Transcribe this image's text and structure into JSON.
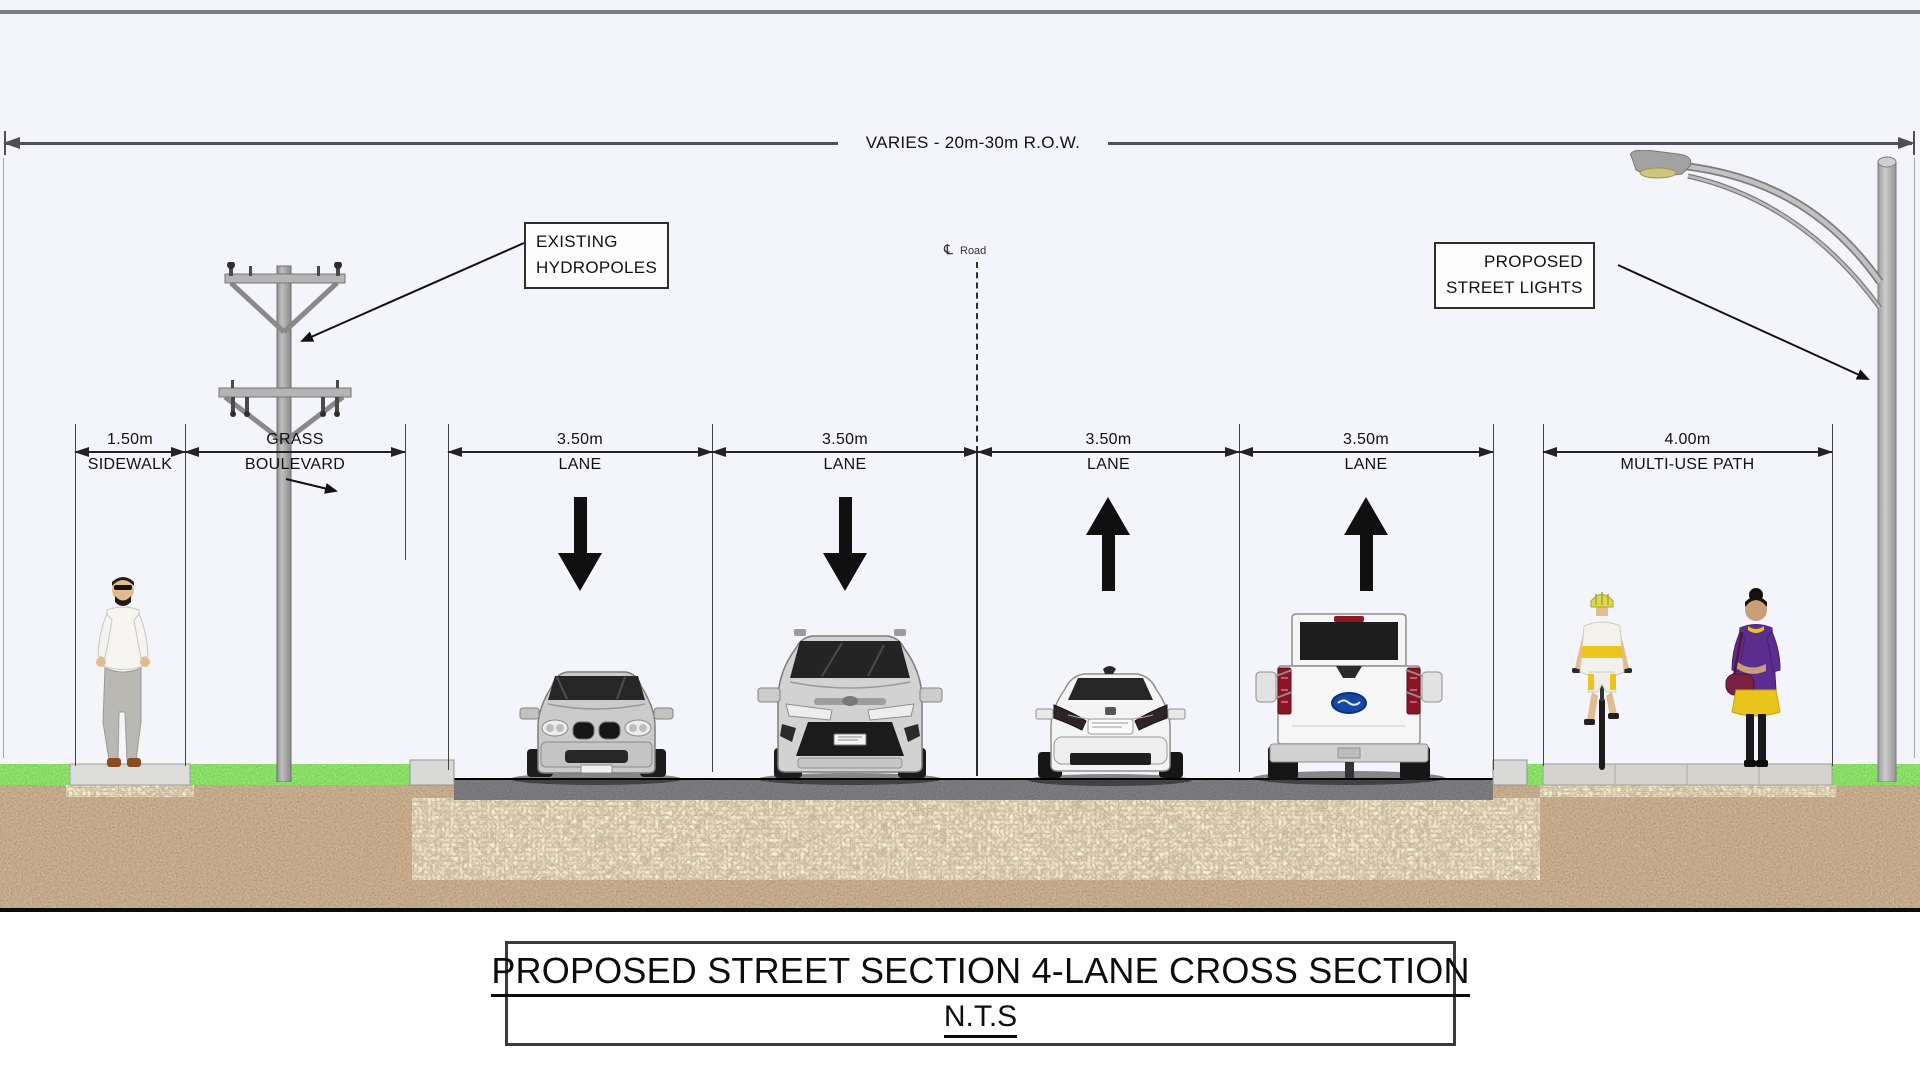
{
  "sheet": {
    "background_color": "#f4f4fb",
    "row_dimension_label": "VARIES - 20m-30m R.O.W."
  },
  "centerline": {
    "symbol": "℄",
    "label": "Road"
  },
  "callouts": {
    "hydropoles": {
      "line1": "EXISTING",
      "line2": "HYDROPOLES"
    },
    "street_lights": {
      "line1": "PROPOSED",
      "line2": "STREET LIGHTS"
    }
  },
  "dimensions": [
    {
      "value": "1.50m",
      "label": "SIDEWALK"
    },
    {
      "value": "GRASS",
      "label": "BOULEVARD"
    },
    {
      "value": "3.50m",
      "label": "LANE"
    },
    {
      "value": "3.50m",
      "label": "LANE"
    },
    {
      "value": "3.50m",
      "label": "LANE"
    },
    {
      "value": "3.50m",
      "label": "LANE"
    },
    {
      "value": "4.00m",
      "label": "MULTI-USE PATH"
    }
  ],
  "lanes": {
    "traffic_directions": [
      "toward-viewer",
      "toward-viewer",
      "away-from-viewer",
      "away-from-viewer"
    ]
  },
  "scene": {
    "vehicles": [
      {
        "lane": 1,
        "type": "silver sedan, front view"
      },
      {
        "lane": 2,
        "type": "silver minivan, front view"
      },
      {
        "lane": 3,
        "type": "white sedan, rear view"
      },
      {
        "lane": 4,
        "type": "white pickup truck, rear view"
      }
    ],
    "people": [
      {
        "location": "sidewalk",
        "type": "man walking"
      },
      {
        "location": "multi-use path",
        "type": "cyclist"
      },
      {
        "location": "multi-use path",
        "type": "woman standing"
      }
    ],
    "colors": {
      "grass": "#4fae28",
      "asphalt": "#1f1f1f",
      "gravel": "#c9b183",
      "dirt": "#7b6553",
      "concrete": "#dcdcda"
    }
  },
  "title_block": {
    "title": "PROPOSED STREET SECTION 4-LANE CROSS SECTION",
    "scale_note": "N.T.S"
  }
}
